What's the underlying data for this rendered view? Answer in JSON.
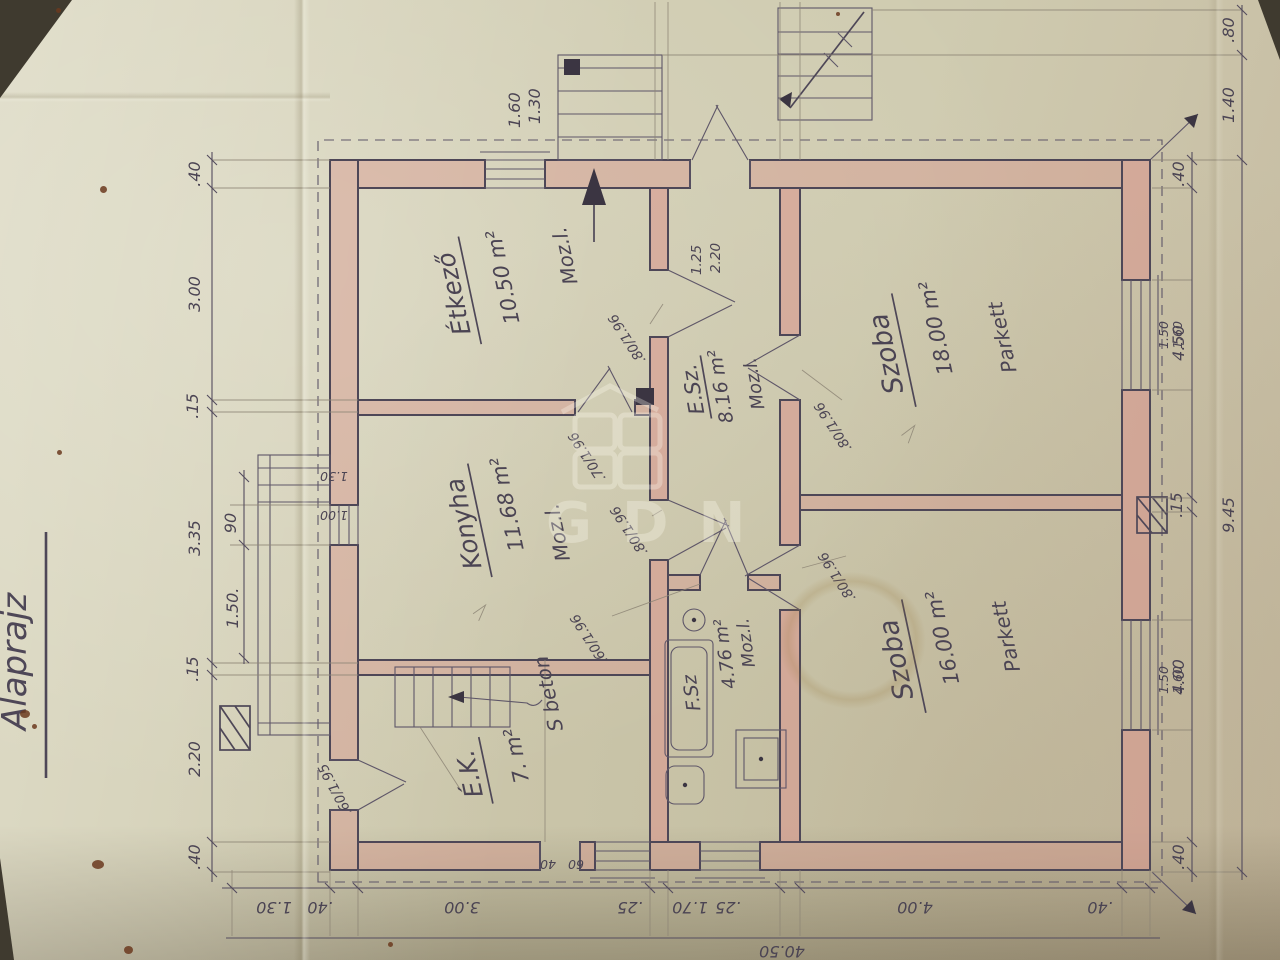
{
  "title": "Alaprajz",
  "watermark": "GDN",
  "colors": {
    "paper": "#cfcbb0",
    "ink": "#4e4757",
    "wall_pink": "#d89a90",
    "stain": "#6b3a1f"
  },
  "rooms": [
    {
      "name": "Étkező",
      "area": "10.50 m²",
      "floor": "Moz.l."
    },
    {
      "name": "Konyha",
      "area": "11.68 m²",
      "floor": "Moz.l."
    },
    {
      "name": "É.K.",
      "area": "7. m²",
      "floor": "S beton"
    },
    {
      "name": "E.Sz.",
      "area": "8.16 m²",
      "floor": "Moz.l."
    },
    {
      "name": "F.Sz",
      "area": "4.76 m²",
      "floor": "Moz.l."
    },
    {
      "name": "Szoba",
      "area": "18.00 m²",
      "floor": "Parkett"
    },
    {
      "name": "Szoba",
      "area": "16.00 m²",
      "floor": "Parkett"
    }
  ],
  "dims": {
    "top_outer": [
      ".40",
      "2.20",
      ".15",
      "3.35",
      ".15",
      "3.00",
      ".40"
    ],
    "top_inner": [
      "1.50.",
      "90"
    ],
    "left": [
      "1.30",
      ".40",
      "3.00",
      ".25",
      "1.70",
      ".25",
      "4.00",
      ".40"
    ],
    "left_total": "40.50",
    "bottom": [
      ".40",
      "4.00",
      ".15",
      "4.50",
      ".40"
    ],
    "bottom_total": "9.45",
    "bottom_ext": [
      "1.40",
      ".80"
    ],
    "window_pair": [
      "1.50",
      "1.60"
    ],
    "entry_door": [
      "1.25",
      "2.20"
    ],
    "steps_right": [
      "1.60",
      "1.30"
    ],
    "terrace_steps": [
      "1.30",
      "1.00"
    ],
    "vent": [
      "40",
      "60"
    ],
    "doors": [
      ".80/1.96",
      ".80/1.96",
      ".70/1.96",
      ".60/1.96",
      ".80/1.96",
      ".80/1.96",
      ".60/1.95"
    ]
  }
}
